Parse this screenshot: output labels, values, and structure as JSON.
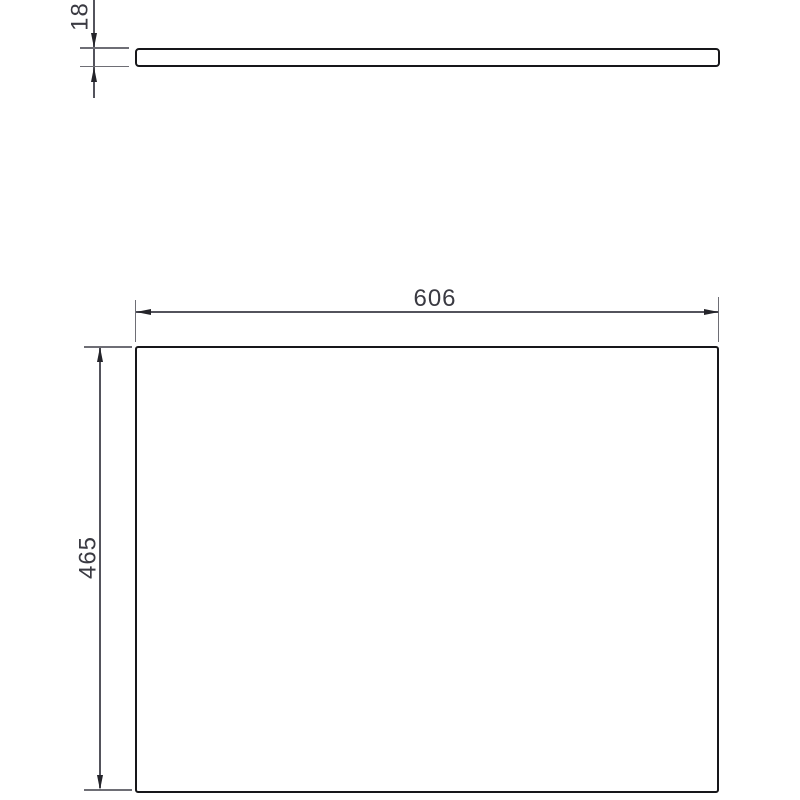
{
  "drawing": {
    "kind": "technical-drawing",
    "dimensions": {
      "thickness": {
        "value": "18",
        "orientation": "vertical",
        "applies_to": "side-view"
      },
      "width": {
        "value": "606",
        "orientation": "horizontal",
        "applies_to": "top-view"
      },
      "height": {
        "value": "465",
        "orientation": "vertical",
        "applies_to": "top-view"
      }
    },
    "colors": {
      "outline": "#17171a",
      "dimension_line": "#53535c",
      "extension_line": "#6e6e75",
      "arrow": "#24242a",
      "label_text": "#3a3a42",
      "background": "#ffffff"
    }
  }
}
